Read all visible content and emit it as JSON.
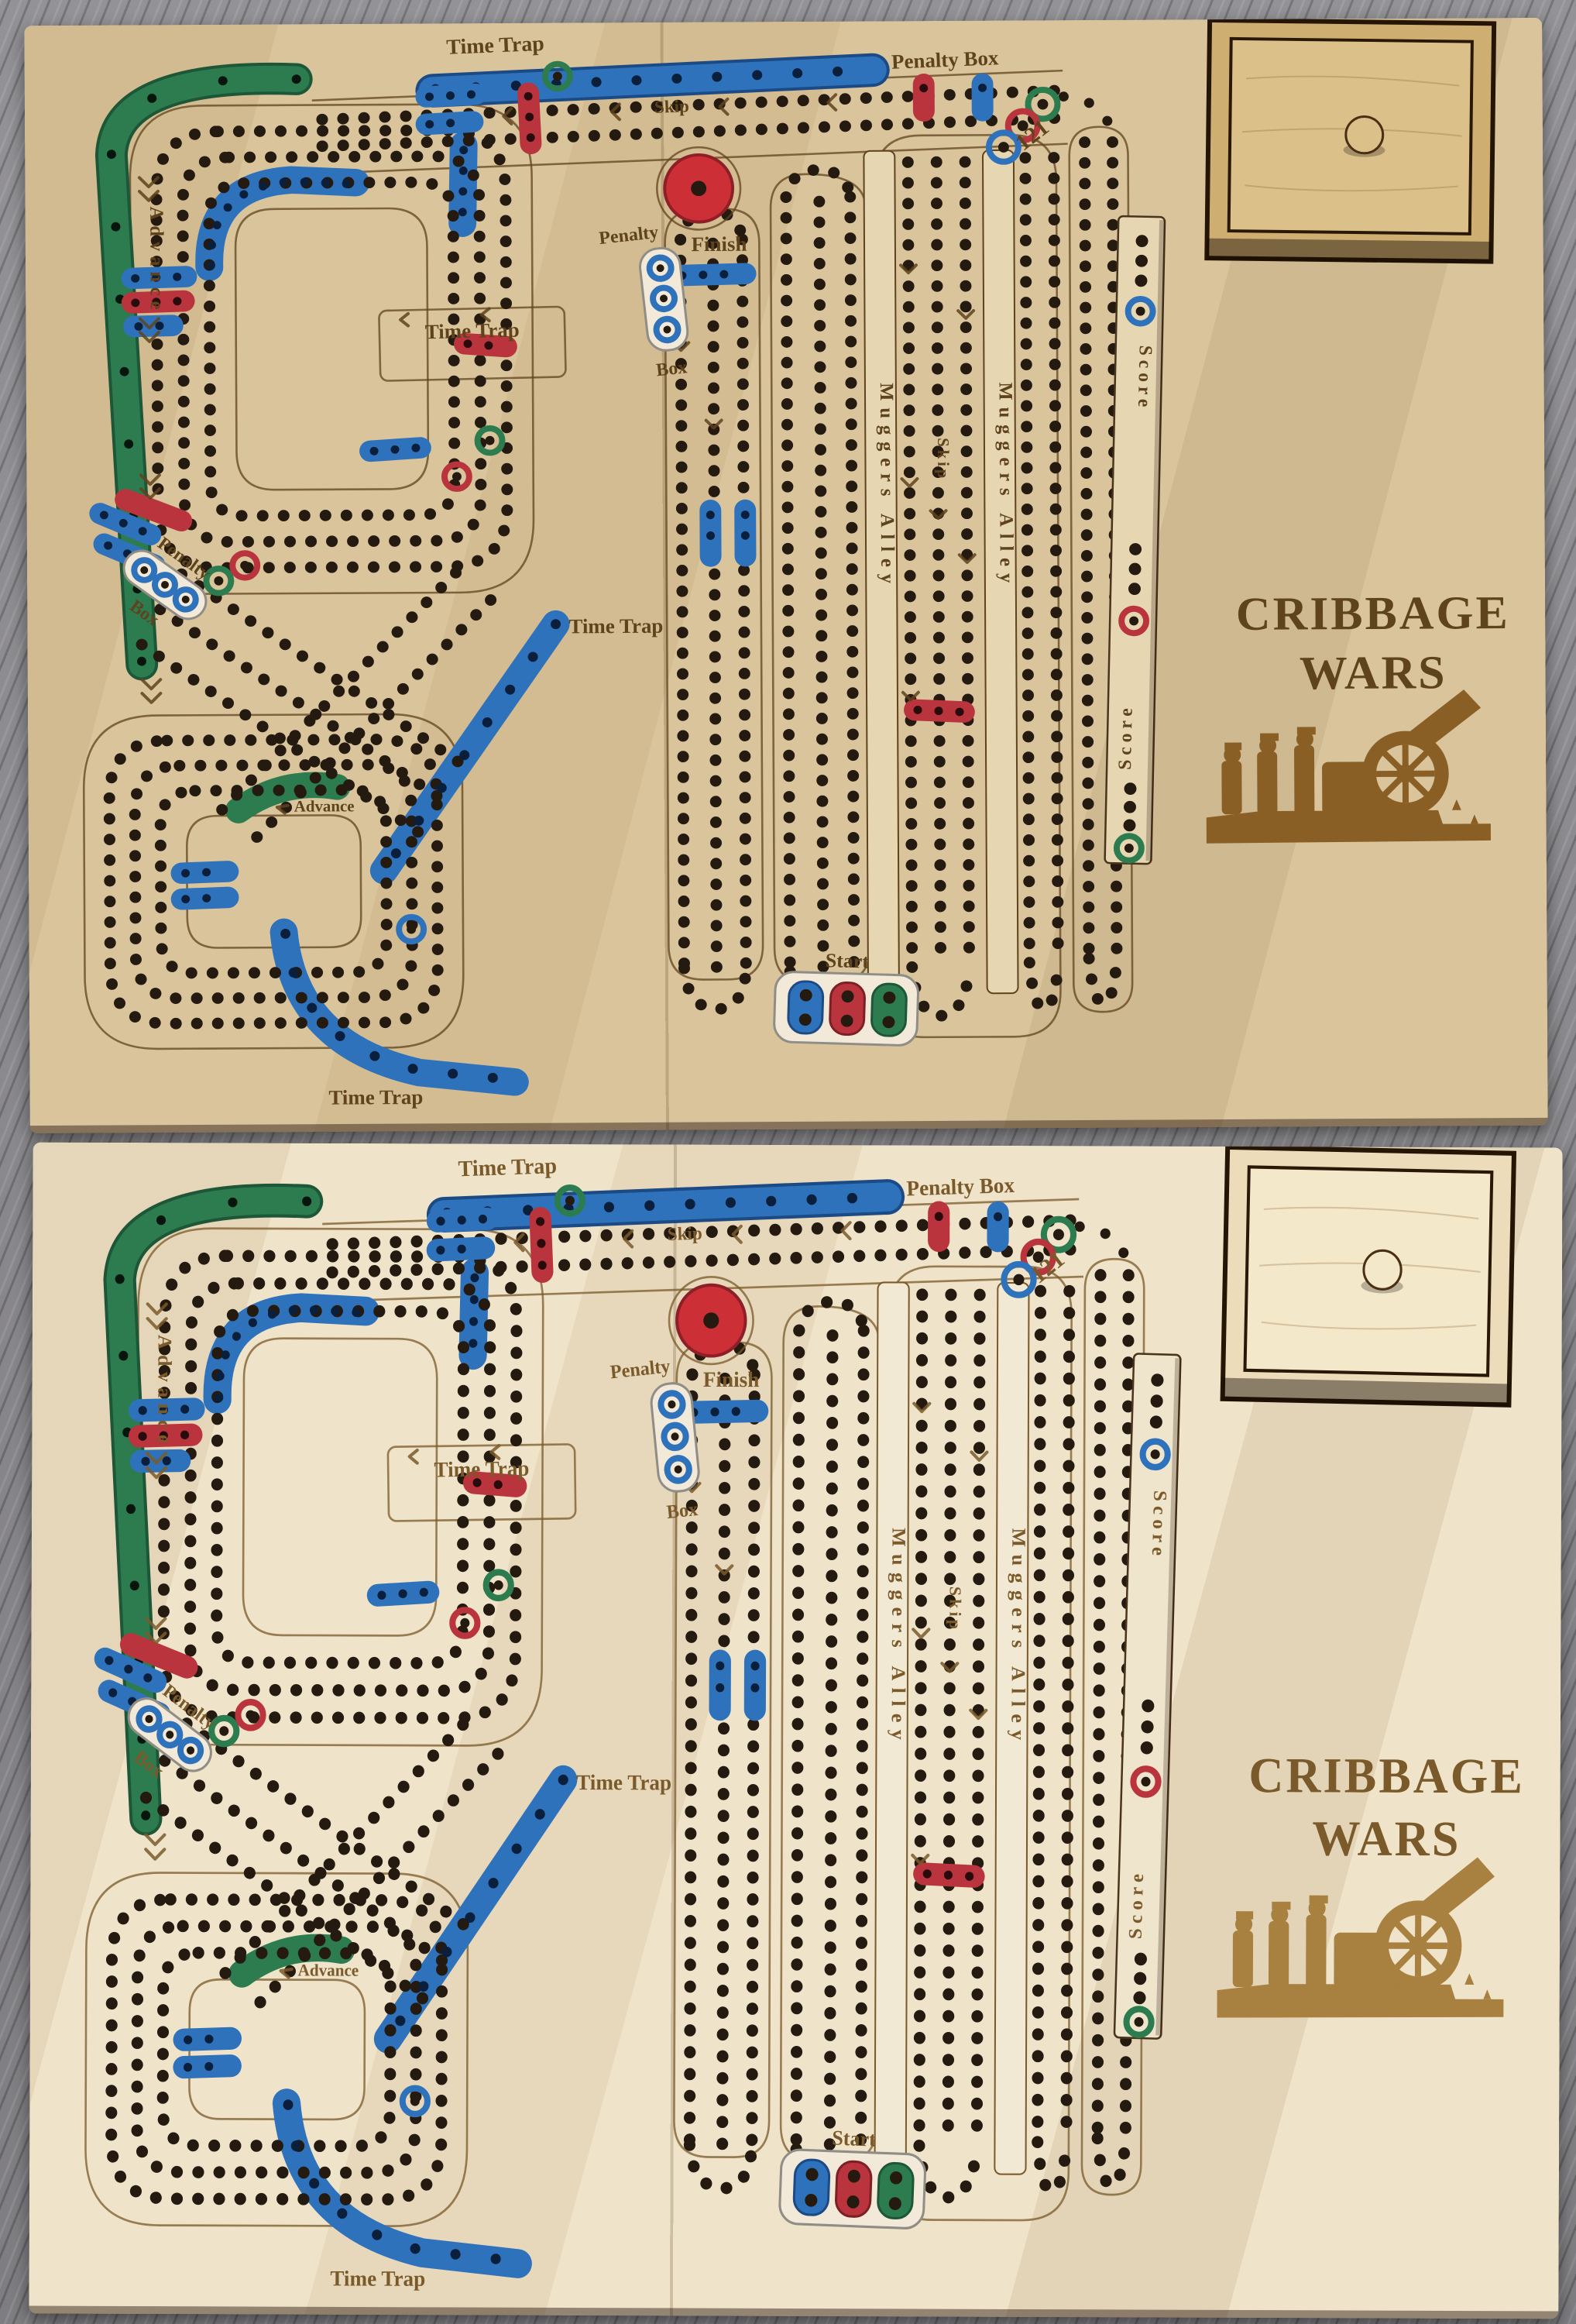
{
  "scene": {
    "floor_color": "#8d8c90",
    "board_count": 2
  },
  "title": {
    "line1": "CRIBBAGE",
    "line2": "WARS"
  },
  "labels": {
    "time_trap": "Time Trap",
    "penalty_box": "Penalty Box",
    "penalty": "Penalty",
    "box": "Box",
    "skip": "Skip",
    "advance": "Advance",
    "finish": "Finish",
    "start": "Start",
    "muggers_alley": "Muggers Alley",
    "score": "Score",
    "finish_number": "121"
  },
  "colors": {
    "board_wood_upper": "#d9c49c",
    "board_wood_lower": "#efe3c9",
    "track_green": "#2c7c50",
    "track_blue": "#2f72bc",
    "track_red": "#b9343c",
    "finish_knob_red": "#cc2f36",
    "peg_hole_dark": "#241a10",
    "engraving_brown": "#5f431d",
    "floor_gray": "#8d8c90"
  },
  "boards": [
    {
      "position": "upper",
      "wood_hex": "#d9c49c"
    },
    {
      "position": "lower",
      "wood_hex": "#efe3c9"
    }
  ]
}
